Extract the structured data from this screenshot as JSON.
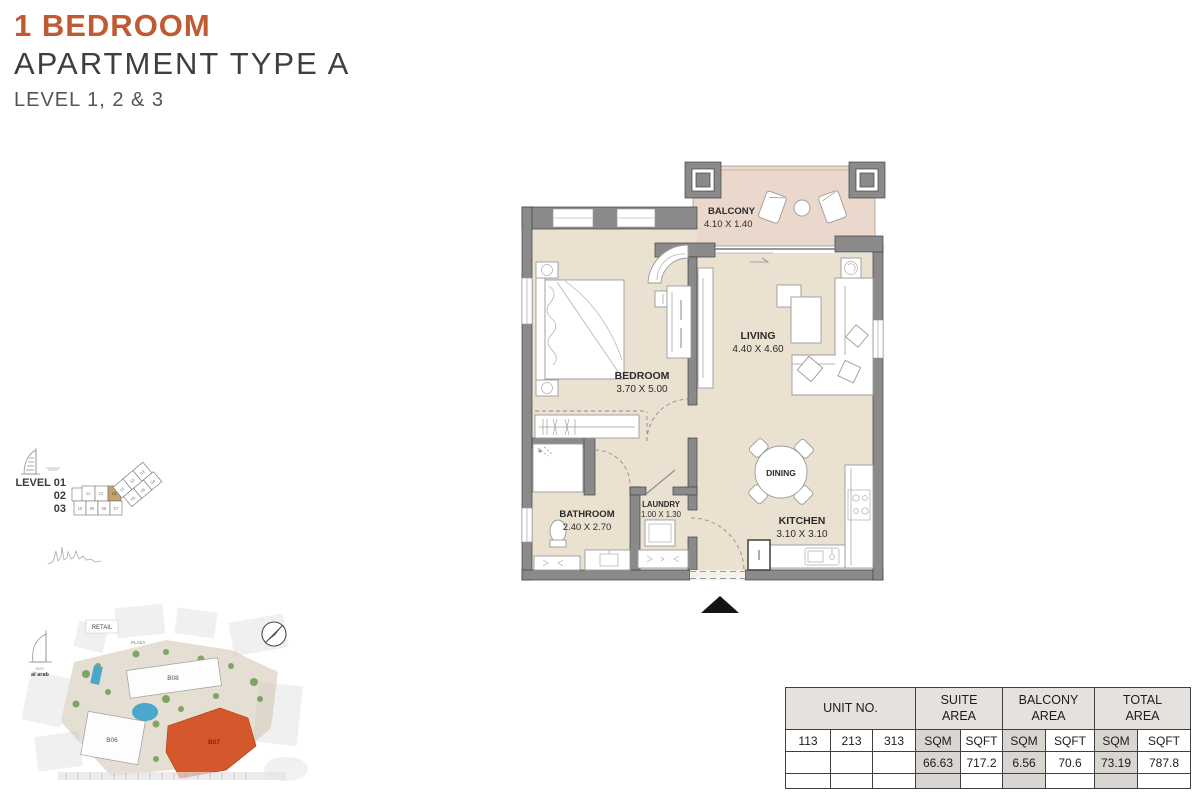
{
  "title": {
    "line1": "1 BEDROOM",
    "line2": "APARTMENT TYPE A",
    "line3": "LEVEL 1, 2 & 3",
    "accent_color": "#C05A33"
  },
  "floor_plan": {
    "balcony": {
      "name": "BALCONY",
      "dims": "4.10 X 1.40"
    },
    "bedroom": {
      "name": "BEDROOM",
      "dims": "3.70 X 5.00"
    },
    "living": {
      "name": "LIVING",
      "dims": "4.40 X 4.60"
    },
    "bathroom": {
      "name": "BATHROOM",
      "dims": "2.40 X 2.70"
    },
    "laundry": {
      "name": "LAUNDRY",
      "dims": "1.00 X 1.30"
    },
    "dining": {
      "name": "DINING"
    },
    "kitchen": {
      "name": "KITCHEN",
      "dims": "3.10 X 3.10"
    },
    "colors": {
      "floor": "#EBE1D1",
      "balcony_floor": "#E9D8CB",
      "wall": "#8A8A8A"
    }
  },
  "level_key": {
    "line1": "LEVEL 01",
    "line2": "02",
    "line3": "03",
    "wing_diag_top": [
      "01",
      "02",
      "03"
    ],
    "wing_diag_bottom": [
      "06",
      "05",
      "04"
    ],
    "wing_horiz_top": [
      "11",
      "12",
      "13"
    ],
    "wing_horiz_bottom": [
      "10",
      "09",
      "08",
      "07"
    ],
    "highlight_unit": "13",
    "highlight_color": "#C2A36B"
  },
  "site_map": {
    "retail": "RETAIL",
    "plaza": "PLAZA",
    "burj_line1": "BURJ",
    "burj_line2": "al arab",
    "b08": "B08",
    "b06": "B06",
    "b07": "B07",
    "highlight_color": "#D4582B"
  },
  "area_table": {
    "unit_no_label": "UNIT NO.",
    "units": [
      "113",
      "213",
      "313"
    ],
    "groups": [
      {
        "line1": "SUITE",
        "line2": "AREA",
        "sqm_label": "SQM",
        "sqft_label": "SQFT",
        "sqm": "66.63",
        "sqft": "717.2"
      },
      {
        "line1": "BALCONY",
        "line2": "AREA",
        "sqm_label": "SQM",
        "sqft_label": "SQFT",
        "sqm": "6.56",
        "sqft": "70.6"
      },
      {
        "line1": "TOTAL",
        "line2": "AREA",
        "sqm_label": "SQM",
        "sqft_label": "SQFT",
        "sqm": "73.19",
        "sqft": "787.8"
      }
    ]
  }
}
